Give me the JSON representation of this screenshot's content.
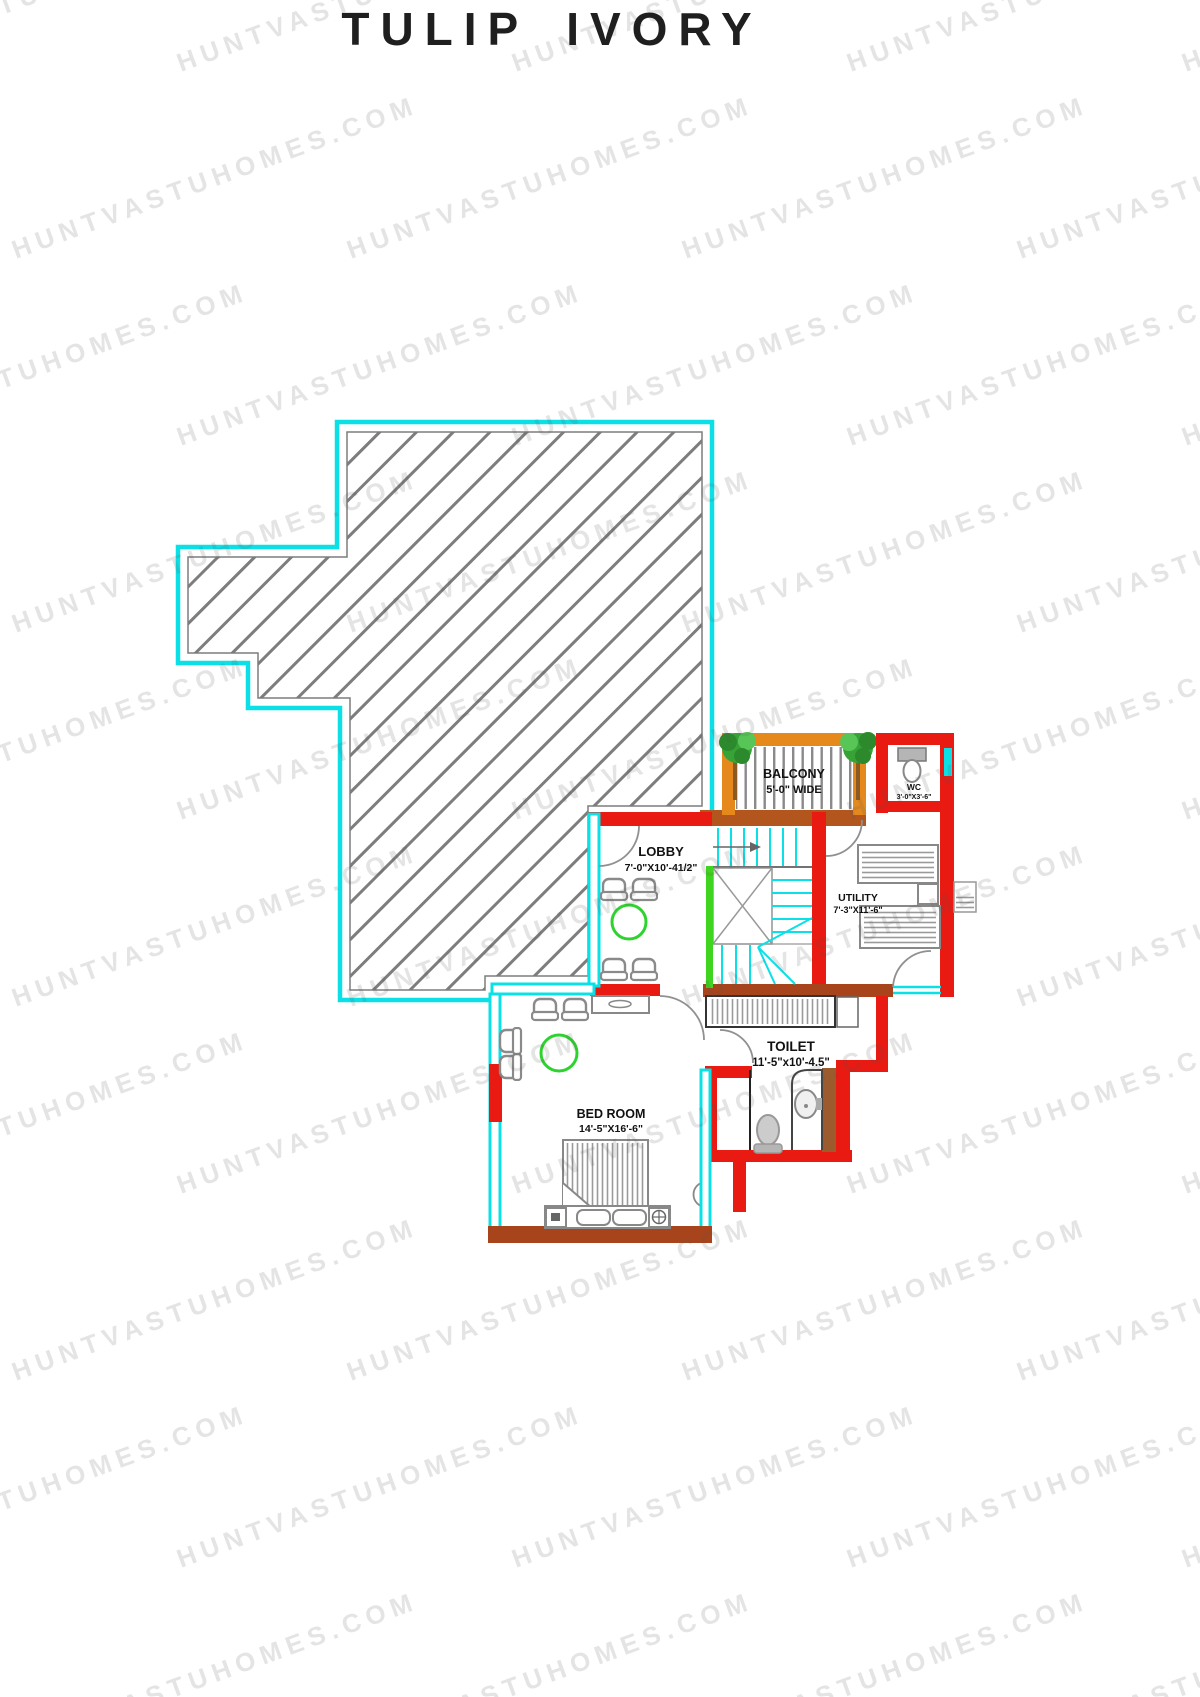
{
  "title": "TULIP IVORY",
  "watermark": {
    "text": "HUNTVASTUHOMES.COM"
  },
  "colors": {
    "wall_red": "#e81a12",
    "wall_brown": "#a8441b",
    "balcony_orange": "#e5891d",
    "wall_cyan": "#0ae0e6",
    "stair_green": "#3fd41f",
    "table_green": "#2fd32f",
    "hatch_gray": "#7d7d7d",
    "furniture_gray": "#8a8a8a"
  },
  "rooms": {
    "balcony": {
      "name": "BALCONY",
      "dims": "5'-0\" WIDE"
    },
    "wc": {
      "name": "WC",
      "dims": "3'-0\"X3'-6\""
    },
    "lobby": {
      "name": "LOBBY",
      "dims": "7'-0\"X10'-41/2\""
    },
    "utility": {
      "name": "UTILITY",
      "dims": "7'-3\"X11'-6\""
    },
    "toilet": {
      "name": "TOILET",
      "dims": "11'-5\"x10'-4.5\""
    },
    "bedroom": {
      "name": "BED ROOM",
      "dims": "14'-5\"X16'-6\""
    }
  }
}
